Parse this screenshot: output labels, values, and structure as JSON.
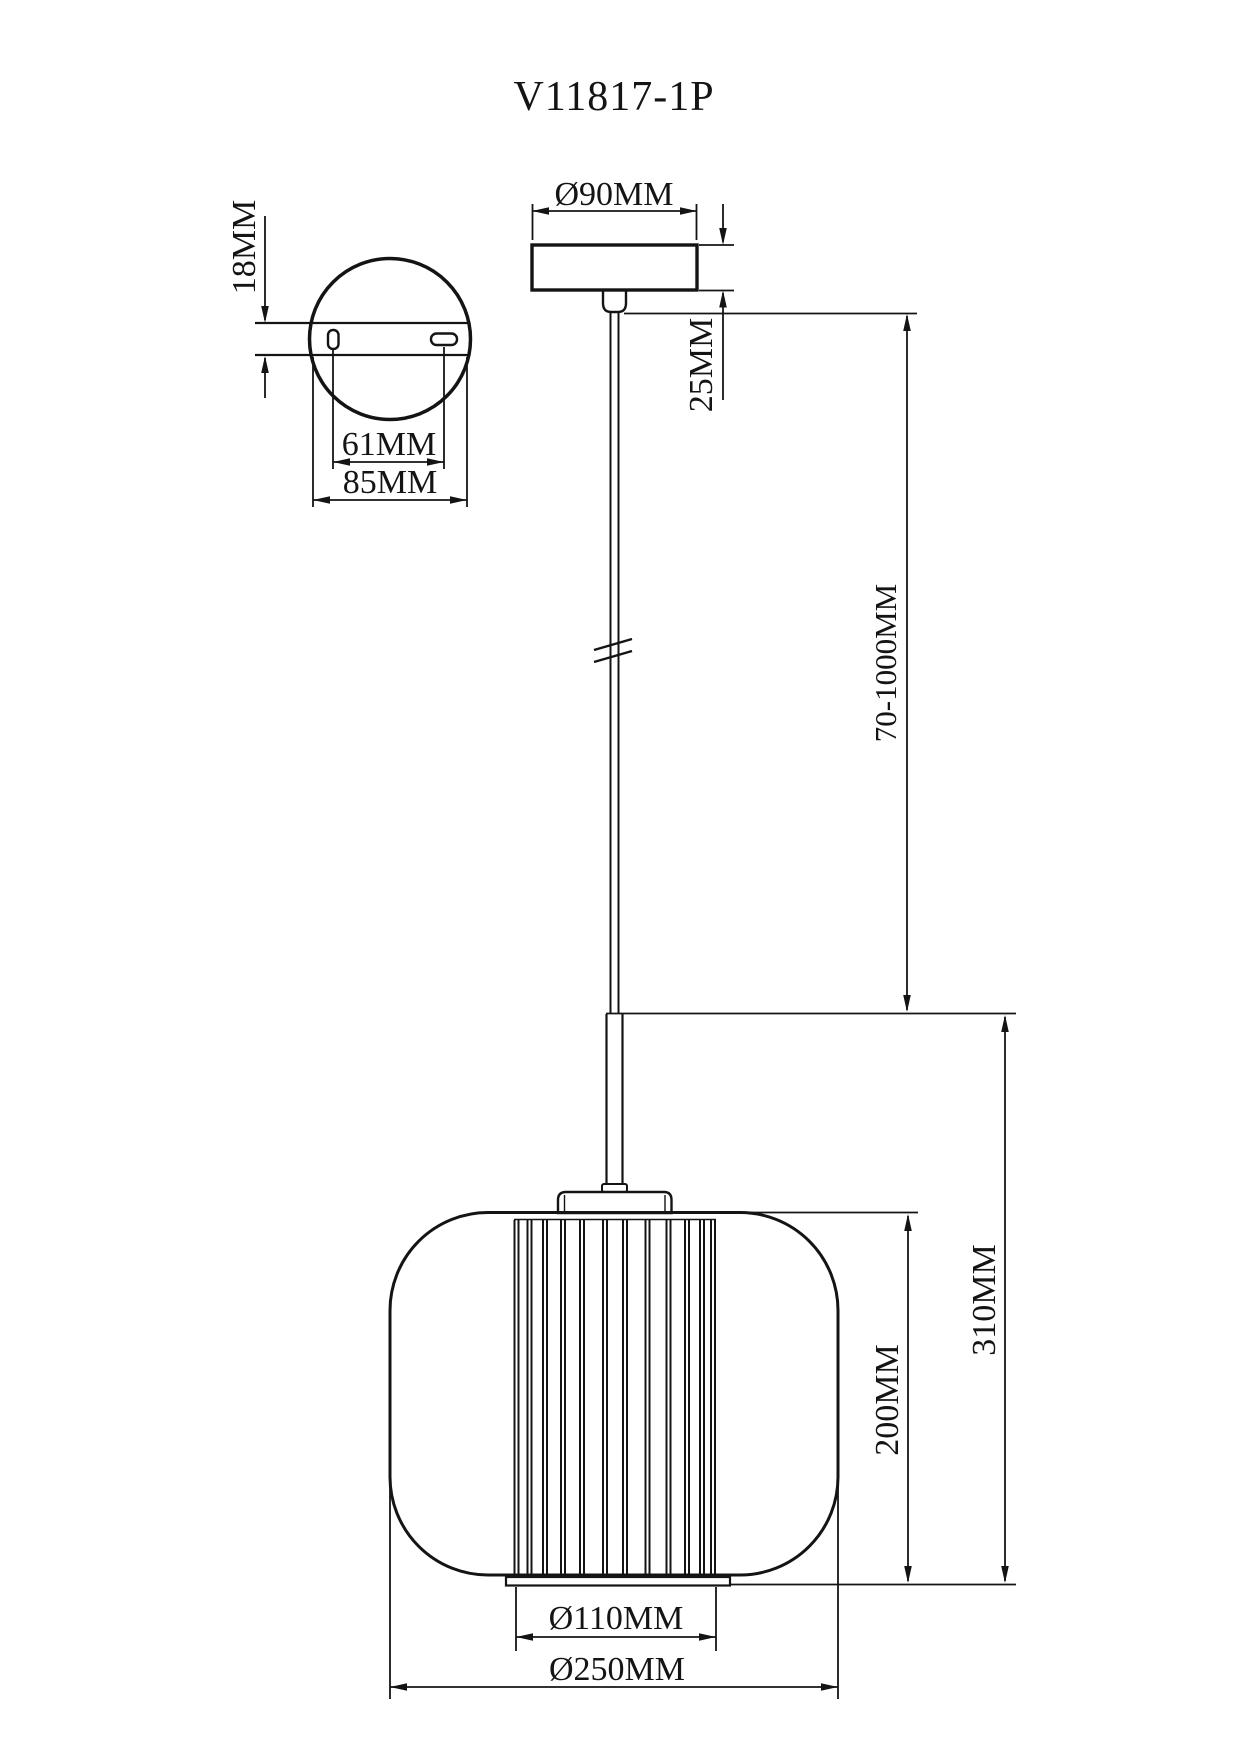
{
  "drawing": {
    "title": "V11817-1P",
    "mount_plate_view": {
      "plate_thickness": "18MM",
      "slot_spacing": "61MM",
      "plate_width": "85MM"
    },
    "canopy_view": {
      "canopy_diameter": "Ø90MM",
      "canopy_height": "25MM",
      "suspension_length": "70-1000MM"
    },
    "shade_view": {
      "glass_height": "200MM",
      "fixture_height": "310MM",
      "inner_diameter": "Ø110MM",
      "shade_diameter": "Ø250MM"
    }
  }
}
